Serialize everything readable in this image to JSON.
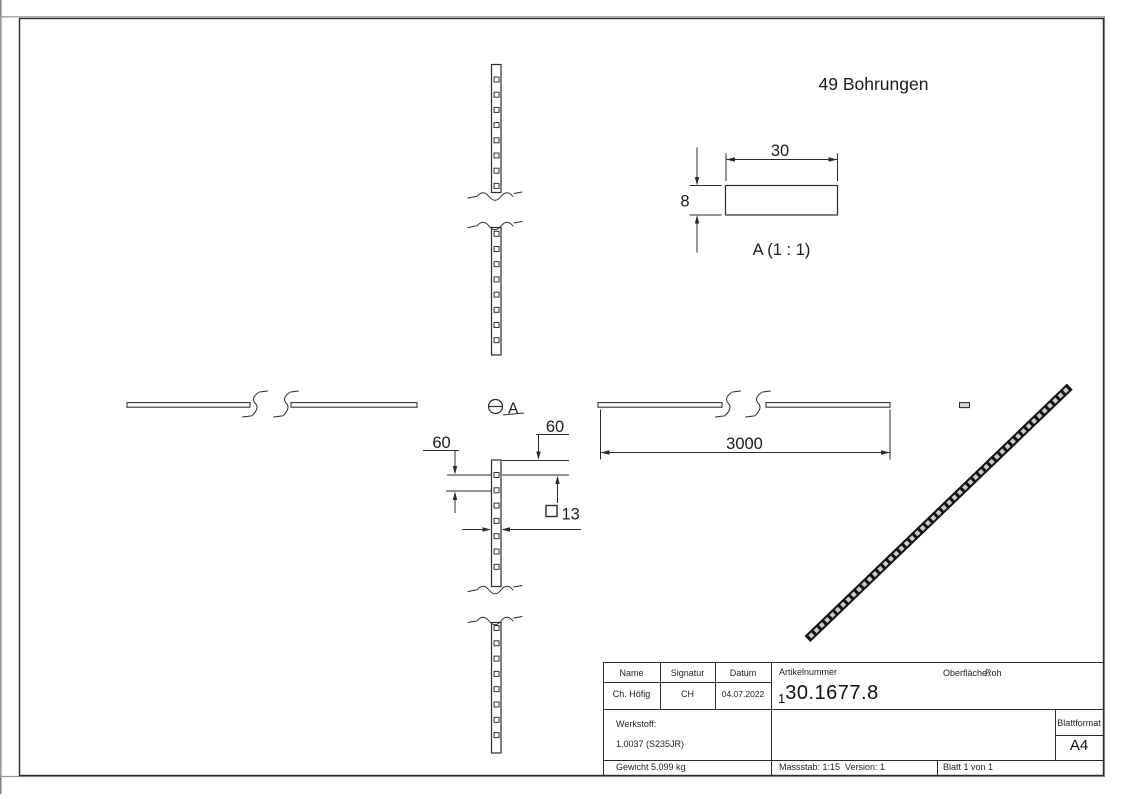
{
  "sheet": {
    "annotation": "49 Bohrungen",
    "hole_count": 49,
    "detail_view": {
      "label": "A (1 : 1)",
      "width_dim": "30",
      "height_dim": "8"
    },
    "dimensions": {
      "overall_length": "3000",
      "hole_pitch_left": "60",
      "hole_pitch_right": "60",
      "hole_size": "13",
      "hole_size_symbol": "□"
    },
    "section_marker": "A"
  },
  "title_block": {
    "name_label": "Name",
    "signatur_label": "Signatur",
    "datum_label": "Datum",
    "name_value": "Ch. Höfig",
    "signatur_value": "CH",
    "datum_value": "04.07.2022",
    "artikelnummer_label": "Artikelnummer",
    "artikelnummer_value": "130.1677.8",
    "artikelnummer_prefix": "1",
    "artikelnummer_main": "30.1677.8",
    "oberflaeche_label": "Oberfläche:",
    "oberflaeche_value": "Roh",
    "werkstoff_label": "Werkstoff:",
    "werkstoff_value": "1.0037 (S235JR)",
    "blattformat_label": "Blattformat",
    "blattformat_value": "A4",
    "gewicht_text": "Gewicht 5.099 kg",
    "massstab_text": "Massstab: 1:15",
    "version_text": "Version: 1",
    "blatt_text": "Blatt 1 von 1"
  },
  "colors": {
    "line": "#2b2b2b",
    "iso_bar": "#141414",
    "iso_hole": "#cbcbcb"
  }
}
